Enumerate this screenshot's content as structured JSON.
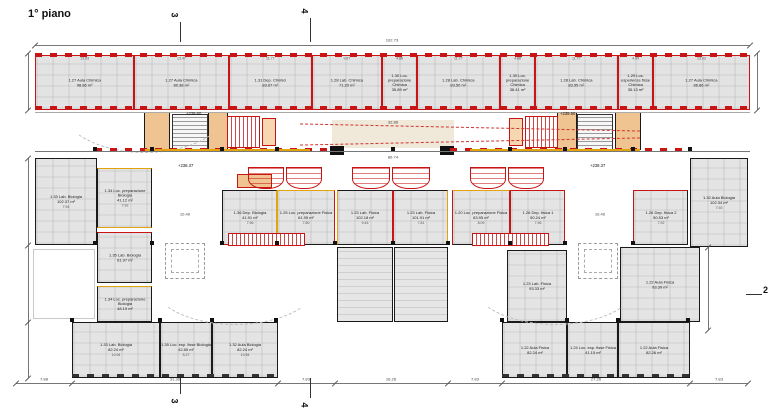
{
  "title": "1° piano",
  "atrio_label": "ATRIO",
  "colors": {
    "red": "#c81414",
    "orange": "#e2a40c",
    "black": "#1a1a1a",
    "room_fill": "#e4e4e4",
    "beige": "#f0e8d8"
  },
  "top_dim": {
    "label": "102.73",
    "y": 45,
    "x1": 35,
    "x2": 750,
    "cx": 392
  },
  "band": {
    "x": 35,
    "y": 55,
    "w": 715,
    "h": 55,
    "rooms": [
      {
        "name": "1.27 Aula Chimica",
        "area": "98.86 m²",
        "dim": "13.93",
        "x": 35,
        "w": 98.6
      },
      {
        "name": "1.27 Aula Chimica",
        "area": "80.38 m²",
        "dim": "13.47",
        "x": 133.6,
        "w": 95.4
      },
      {
        "name": "1.31 Dep. Chimici",
        "area": "83.67 m²",
        "dim": "11.77",
        "x": 229,
        "w": 83.3
      },
      {
        "name": "1.28 Lab. Chimica",
        "area": "71.20 m²",
        "dim": "9.87",
        "x": 312.3,
        "w": 69.9
      },
      {
        "name": "1.30 Loc. preparazione Chimica",
        "area": "35.89 m²",
        "dim": "4.88",
        "x": 382.2,
        "w": 34.6
      },
      {
        "name": "1.28 Lab. Chimica",
        "area": "83.50 m²",
        "dim": "11.77",
        "x": 416.8,
        "w": 83.3
      },
      {
        "name": "1.30 Loc. preparazione Chimica",
        "area": "38.41 m²",
        "dim": "4.88",
        "x": 500.1,
        "w": 34.6
      },
      {
        "name": "1.28 Lab. Chimica",
        "area": "83.55 m²",
        "dim": "11.77",
        "x": 534.7,
        "w": 83.3
      },
      {
        "name": "1.29 Loc. esperienze fisse Chimica",
        "area": "35.13 m²",
        "dim": "4.99",
        "x": 618,
        "w": 34.6
      },
      {
        "name": "1.27 Aula Chimica",
        "area": "86.86 m²",
        "dim": "13.93",
        "x": 652.6,
        "w": 97.4
      }
    ]
  },
  "rooms": [
    {
      "name": "1.33 Lab. Biologia",
      "area": "102.37 m²",
      "dim": "7.94",
      "x": 35,
      "y": 158,
      "w": 62,
      "h": 87,
      "walls": "kkkk"
    },
    {
      "name": "1.34 Loc. preparazione Biologia",
      "area": "41.12 m²",
      "dim": "7.92",
      "x": 97,
      "y": 168,
      "w": 55,
      "h": 60,
      "walls": "okok"
    },
    {
      "name": "1.36 Dep. Biologia",
      "area": "41.91 m²",
      "dim": "7.96",
      "x": 222,
      "y": 190,
      "w": 55,
      "h": 55,
      "walls": "kork"
    },
    {
      "name": "1.25 Loc. preparazione Fisica",
      "area": "61.95 m²",
      "dim": "7.80",
      "x": 277,
      "y": 190,
      "w": 58,
      "h": 55,
      "walls": "orko"
    },
    {
      "name": "1.23 Lab. Fisica",
      "area": "102.18 m²",
      "dim": "9.45",
      "x": 337,
      "y": 190,
      "w": 56,
      "h": 55,
      "walls": "krko"
    },
    {
      "name": "1.23 Lab. Fisica",
      "area": "101.91 m²",
      "dim": "7.81",
      "x": 393,
      "y": 190,
      "w": 55,
      "h": 55,
      "walls": "kokr"
    },
    {
      "name": "1.20 Loc. preparazione Fisica",
      "area": "63.95 m²",
      "dim": "8.09",
      "x": 452,
      "y": 190,
      "w": 58,
      "h": 55,
      "walls": "orkr"
    },
    {
      "name": "1.26 Dep. fisica 1",
      "area": "50.24 m²",
      "dim": "7.96",
      "x": 510,
      "y": 190,
      "w": 55,
      "h": 55,
      "walls": "rrkr"
    },
    {
      "name": "1.26 Dep. fisica 2",
      "area": "50.53 m²",
      "dim": "7.92",
      "x": 633,
      "y": 190,
      "w": 55,
      "h": 55,
      "walls": "rkkr"
    },
    {
      "name": "1.32 Aula Biologia",
      "area": "102.34 m²",
      "dim": "7.92",
      "x": 690,
      "y": 158,
      "w": 58,
      "h": 89,
      "walls": "kkkk"
    },
    {
      "name": "1.35 Lab. Biologia",
      "area": "61.97 m²",
      "dim": "",
      "x": 97,
      "y": 232,
      "w": 55,
      "h": 51,
      "walls": "rkkk"
    },
    {
      "name": "1.34 Loc. preparazione Biologia",
      "area": "48.19 m²",
      "dim": "",
      "x": 97,
      "y": 286,
      "w": 55,
      "h": 36,
      "walls": "okkk"
    },
    {
      "name": "1.23 Lab. Fisica",
      "area": "93.33 m²",
      "dim": "",
      "x": 507,
      "y": 250,
      "w": 60,
      "h": 72,
      "walls": "kkkk"
    },
    {
      "name": "1.22 Aula Fisica",
      "area": "93.39 m²",
      "dim": "",
      "x": 620,
      "y": 247,
      "w": 80,
      "h": 75,
      "walls": "kkkk"
    },
    {
      "name": "1.33 Lab. Biologia",
      "area": "82.24 m²",
      "dim": "10.94",
      "x": 72,
      "y": 322,
      "w": 88,
      "h": 56,
      "walls": "kkkk"
    },
    {
      "name": "1.35 Loc. esp. fisse Biologia",
      "area": "42.85 m²",
      "dim": "5.27",
      "x": 160,
      "y": 322,
      "w": 52,
      "h": 56,
      "walls": "kkkk"
    },
    {
      "name": "1.32 Aula Biologia",
      "area": "82.24 m²",
      "dim": "10.94",
      "x": 212,
      "y": 322,
      "w": 66,
      "h": 56,
      "walls": "kkkk"
    },
    {
      "name": "1.22 Aula Fisica",
      "area": "82.24 m²",
      "dim": "",
      "x": 502,
      "y": 322,
      "w": 65,
      "h": 56,
      "walls": "kkkk"
    },
    {
      "name": "1.24 Loc. esp. fisse Fisica",
      "area": "41.15 m²",
      "dim": "",
      "x": 567,
      "y": 322,
      "w": 51,
      "h": 56,
      "walls": "kkkk"
    },
    {
      "name": "1.22 Aula Fisica",
      "area": "82.26 m²",
      "dim": "",
      "x": 618,
      "y": 322,
      "w": 72,
      "h": 56,
      "walls": "kkkk"
    }
  ],
  "bench_blocks": [
    {
      "x": 337,
      "y": 247,
      "w": 56,
      "h": 75
    },
    {
      "x": 394,
      "y": 247,
      "w": 54,
      "h": 75
    }
  ],
  "benches": [
    {
      "x": 248,
      "y": 167,
      "w": 36,
      "h": 22
    },
    {
      "x": 286,
      "y": 167,
      "w": 36,
      "h": 22
    },
    {
      "x": 352,
      "y": 167,
      "w": 38,
      "h": 22
    },
    {
      "x": 392,
      "y": 167,
      "w": 38,
      "h": 22
    },
    {
      "x": 470,
      "y": 167,
      "w": 36,
      "h": 22
    },
    {
      "x": 508,
      "y": 167,
      "w": 36,
      "h": 22
    }
  ],
  "boxes": [
    {
      "x": 332,
      "y": 120,
      "w": 122,
      "h": 28,
      "f": "#f0e8d8",
      "b": "none"
    },
    {
      "x": 144,
      "y": 112,
      "w": 26,
      "h": 38,
      "f": "#f0c490",
      "b": "#1a1a1a"
    },
    {
      "x": 208,
      "y": 112,
      "w": 20,
      "h": 38,
      "f": "#f0c490",
      "b": "#1a1a1a"
    },
    {
      "x": 262,
      "y": 118,
      "w": 14,
      "h": 28,
      "f": "#f6d7b0",
      "b": "#c81414"
    },
    {
      "x": 509,
      "y": 118,
      "w": 14,
      "h": 28,
      "f": "#f6d7b0",
      "b": "#c81414"
    },
    {
      "x": 557,
      "y": 112,
      "w": 20,
      "h": 38,
      "f": "#f0c490",
      "b": "#1a1a1a"
    },
    {
      "x": 615,
      "y": 112,
      "w": 26,
      "h": 38,
      "f": "#f0c490",
      "b": "#1a1a1a"
    },
    {
      "x": 237,
      "y": 174,
      "w": 35,
      "h": 14,
      "f": "#f0c490",
      "b": "#c81414"
    },
    {
      "x": 330,
      "y": 146,
      "w": 14,
      "h": 9,
      "f": "#111111",
      "b": "#111111"
    },
    {
      "x": 440,
      "y": 146,
      "w": 14,
      "h": 9,
      "f": "#111111",
      "b": "#111111"
    }
  ],
  "stairs": [
    {
      "x": 172,
      "y": 114,
      "w": 36,
      "h": 36,
      "kind": "gray"
    },
    {
      "x": 577,
      "y": 114,
      "w": 36,
      "h": 36,
      "kind": "gray"
    },
    {
      "x": 227,
      "y": 116,
      "w": 33,
      "h": 32,
      "kind": "red"
    },
    {
      "x": 525,
      "y": 116,
      "w": 33,
      "h": 32,
      "kind": "red"
    },
    {
      "x": 228,
      "y": 233,
      "w": 77,
      "h": 13,
      "kind": "red"
    },
    {
      "x": 472,
      "y": 233,
      "w": 77,
      "h": 13,
      "kind": "red"
    }
  ],
  "squares": [
    {
      "x": 165,
      "y": 243,
      "w": 40,
      "h": 36
    },
    {
      "x": 578,
      "y": 243,
      "w": 40,
      "h": 36
    }
  ],
  "arcs": [
    {
      "x": 60,
      "y": 58,
      "w": 170,
      "h": 95
    },
    {
      "x": 150,
      "y": 235,
      "w": 170,
      "h": 90
    },
    {
      "x": 470,
      "y": 235,
      "w": 170,
      "h": 90
    }
  ],
  "strips": [
    {
      "x": 35,
      "y": 53,
      "w": 715,
      "h": 4,
      "c": "#c81414"
    },
    {
      "x": 35,
      "y": 106,
      "w": 715,
      "h": 4,
      "c": "#c81414"
    },
    {
      "x": 95,
      "y": 148,
      "w": 240,
      "h": 3,
      "c": "#c81414"
    },
    {
      "x": 450,
      "y": 148,
      "w": 240,
      "h": 3,
      "c": "#c81414"
    },
    {
      "x": 72,
      "y": 374,
      "w": 206,
      "h": 3,
      "c": "#333333"
    },
    {
      "x": 502,
      "y": 374,
      "w": 188,
      "h": 3,
      "c": "#333333"
    }
  ],
  "walls": [
    {
      "x": 35,
      "y": 151,
      "w": 715,
      "h": 1,
      "c": "#777777"
    },
    {
      "x": 35,
      "y": 112,
      "w": 715,
      "h": 1,
      "c": "#aaaaaa"
    },
    {
      "x": 145,
      "y": 149,
      "w": 165,
      "h": 2,
      "c": "#e2a40c"
    },
    {
      "x": 470,
      "y": 149,
      "w": 170,
      "h": 2,
      "c": "#e2a40c"
    }
  ],
  "outline_rects": [
    {
      "x": 33,
      "y": 249,
      "w": 62,
      "h": 70
    }
  ],
  "columns": [
    [
      95,
      149
    ],
    [
      152,
      149
    ],
    [
      222,
      149
    ],
    [
      277,
      149
    ],
    [
      335,
      149
    ],
    [
      393,
      149
    ],
    [
      448,
      149
    ],
    [
      510,
      149
    ],
    [
      565,
      149
    ],
    [
      633,
      149
    ],
    [
      690,
      149
    ],
    [
      95,
      243
    ],
    [
      152,
      243
    ],
    [
      222,
      243
    ],
    [
      277,
      243
    ],
    [
      335,
      243
    ],
    [
      393,
      243
    ],
    [
      448,
      243
    ],
    [
      510,
      243
    ],
    [
      565,
      243
    ],
    [
      633,
      243
    ],
    [
      72,
      320
    ],
    [
      160,
      320
    ],
    [
      212,
      320
    ],
    [
      276,
      320
    ],
    [
      502,
      320
    ],
    [
      567,
      320
    ],
    [
      618,
      320
    ],
    [
      688,
      320
    ]
  ],
  "atrio_lines": [
    {
      "x": 300,
      "y": 127,
      "w": 340,
      "r": 1.2
    },
    {
      "x": 300,
      "y": 141,
      "w": 340,
      "r": -1.2
    }
  ],
  "levels": [
    {
      "t": "+239.60",
      "x": 186,
      "y": 112
    },
    {
      "t": "+239.60",
      "x": 560,
      "y": 112
    },
    {
      "t": "+238.37",
      "x": 178,
      "y": 164
    },
    {
      "t": "+238.37",
      "x": 590,
      "y": 164
    }
  ],
  "free_dims": [
    {
      "t": "32.86",
      "x": 393,
      "y": 119
    },
    {
      "t": "86.74",
      "x": 393,
      "y": 154
    },
    {
      "t": "10.40",
      "x": 185,
      "y": 211
    },
    {
      "t": "10.40",
      "x": 600,
      "y": 211
    }
  ],
  "bottom_dim": {
    "y": 383,
    "ticks": [
      16,
      72,
      278,
      335,
      448,
      502,
      690,
      748
    ],
    "labels": [
      {
        "t": "7.88",
        "cx": 44
      },
      {
        "t": "31.30",
        "cx": 175
      },
      {
        "t": "7.83",
        "cx": 306
      },
      {
        "t": "16.26",
        "cx": 391
      },
      {
        "t": "7.83",
        "cx": 475
      },
      {
        "t": "27.26",
        "cx": 596
      },
      {
        "t": "7.83",
        "cx": 719
      }
    ]
  },
  "side_dims": [
    {
      "x": 28,
      "y1": 53,
      "y2": 110,
      "ticks": [
        53,
        110
      ]
    },
    {
      "x": 28,
      "y1": 158,
      "y2": 378,
      "ticks": [
        158,
        245,
        322,
        378
      ]
    },
    {
      "x": 757,
      "y1": 53,
      "y2": 110,
      "ticks": [
        53,
        110
      ]
    },
    {
      "x": 708,
      "y1": 247,
      "y2": 330,
      "ticks": [
        247,
        330
      ]
    }
  ],
  "markers": [
    {
      "n": "3",
      "x": 172,
      "y": 10,
      "rot": 1,
      "line": [
        180,
        22,
        1,
        20
      ]
    },
    {
      "n": "4",
      "x": 302,
      "y": 6,
      "rot": 1,
      "line": [
        310,
        18,
        1,
        24
      ]
    },
    {
      "n": "3",
      "x": 172,
      "y": 396,
      "rot": 1,
      "line": [
        180,
        378,
        1,
        16
      ]
    },
    {
      "n": "4",
      "x": 302,
      "y": 400,
      "rot": 1,
      "line": [
        310,
        378,
        1,
        20
      ]
    },
    {
      "n": "2",
      "x": 763,
      "y": 285,
      "rot": 0,
      "line": [
        746,
        294,
        16,
        1
      ]
    }
  ]
}
